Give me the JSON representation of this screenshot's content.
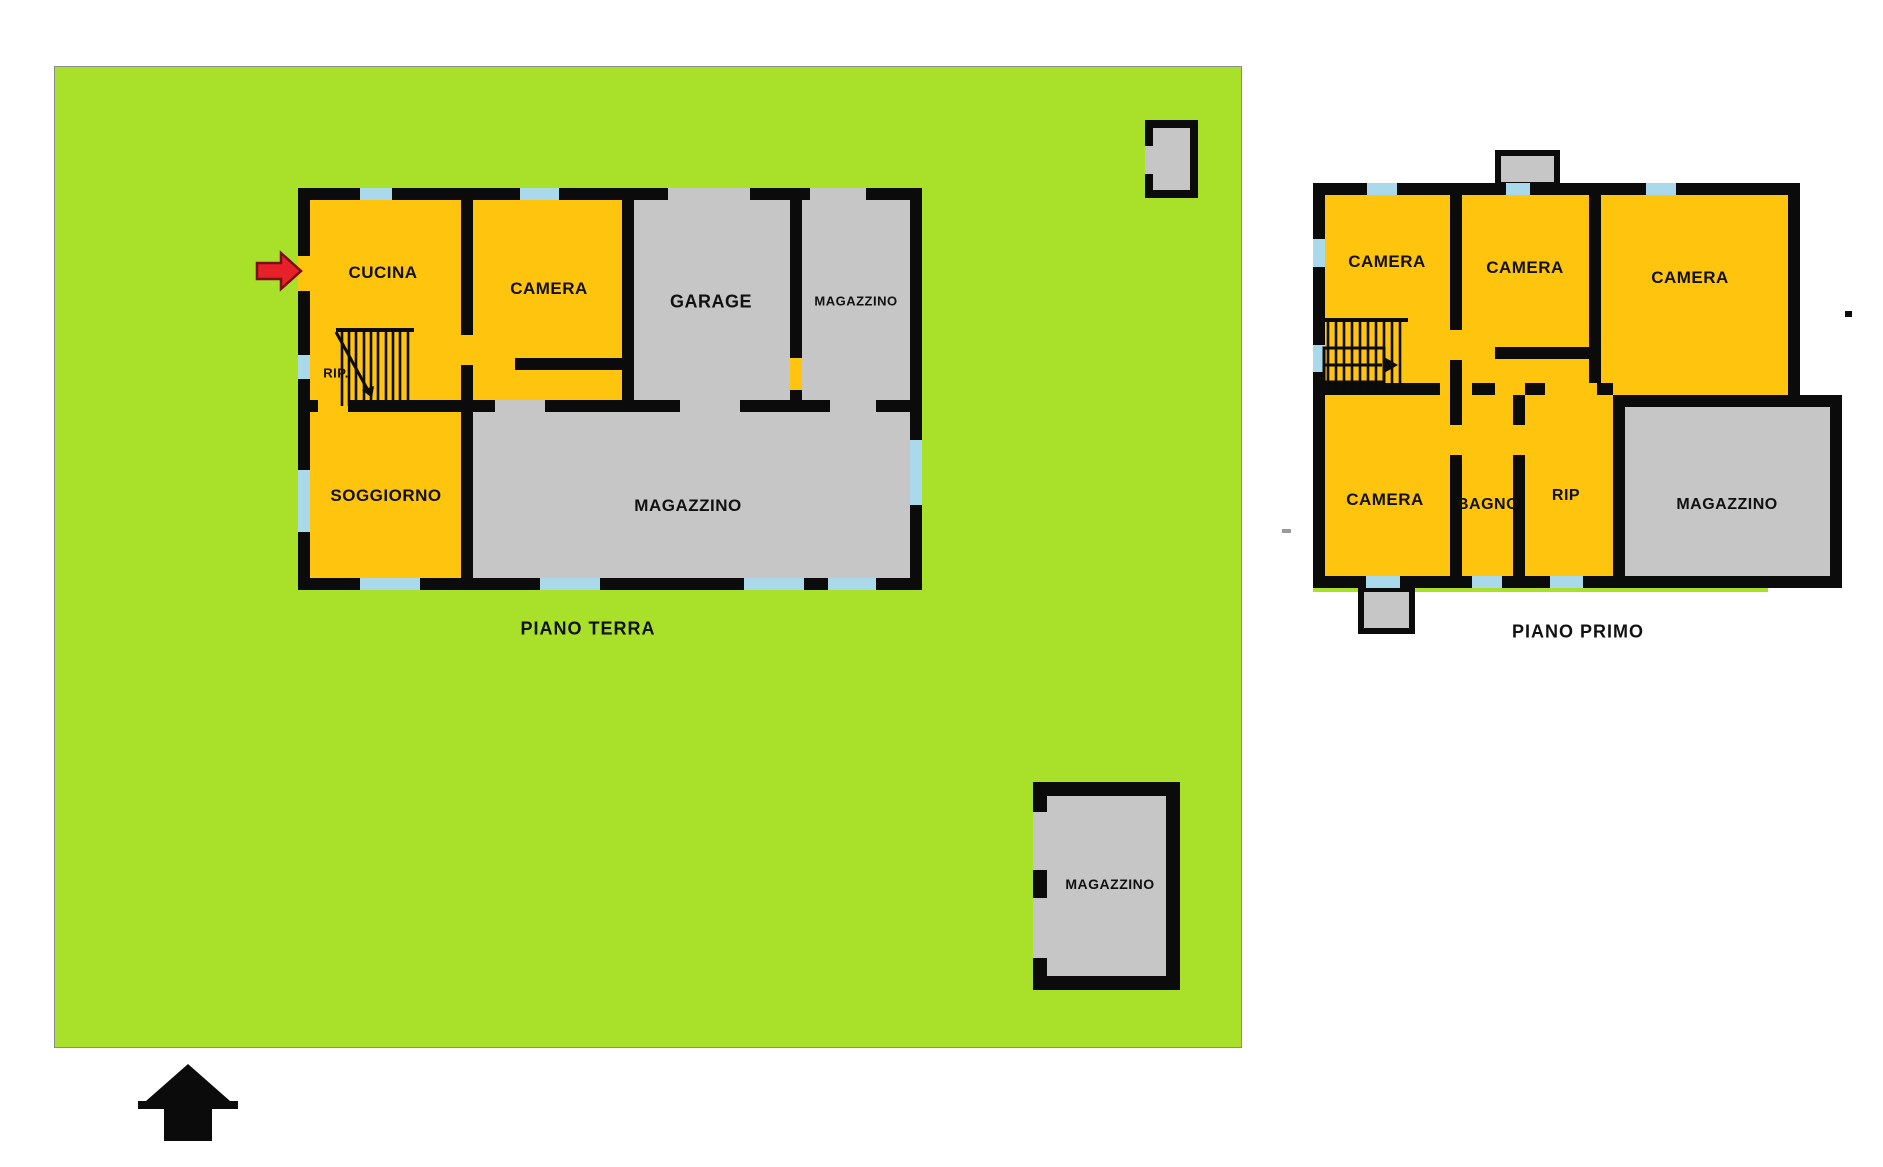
{
  "palette": {
    "lawn": "#a8e02a",
    "room_yellow": "#ffc40e",
    "room_gray": "#c6c6c6",
    "wall": "#0b0b0b",
    "window_blue": "#a9d9ea",
    "arrow_red": "#e62129",
    "arrow_red_outline": "#7c0e13",
    "background": "#ffffff",
    "text": "#111111"
  },
  "ground_floor": {
    "title": "PIANO TERRA",
    "rooms": {
      "cucina": "CUCINA",
      "camera": "CAMERA",
      "garage": "GARAGE",
      "magazzino_top": "MAGAZZINO",
      "rip": "RIP.",
      "soggiorno": "SOGGIORNO",
      "magazzino_main": "MAGAZZINO"
    }
  },
  "first_floor": {
    "title": "PIANO PRIMO",
    "rooms": {
      "camera_nw": "CAMERA",
      "camera_n": "CAMERA",
      "camera_ne": "CAMERA",
      "camera_sw": "CAMERA",
      "bagno": "BAGNO",
      "rip": "RIP",
      "magazzino": "MAGAZZINO"
    }
  },
  "outbuilding": {
    "magazzino": "MAGAZZINO"
  },
  "icons": {
    "entrance_arrow": "red-arrow-right",
    "north_arrow": "black-up-arrow",
    "stairs": "staircase"
  }
}
